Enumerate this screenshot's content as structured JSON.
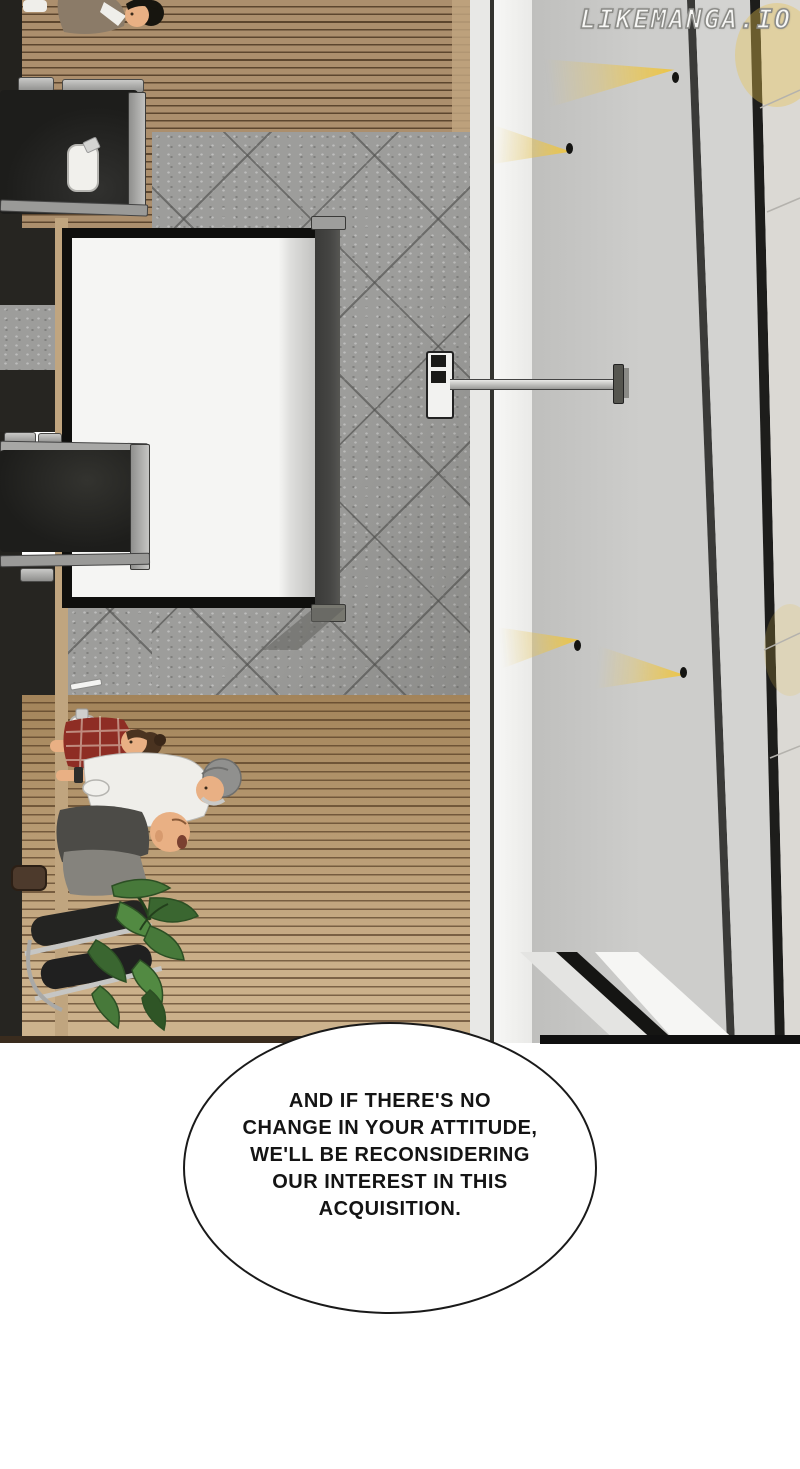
{
  "page": {
    "width_px": 800,
    "height_px": 1469,
    "background": "#ffffff"
  },
  "watermark": {
    "text": "LIKEMANGA.IO"
  },
  "speech_bubble": {
    "lines": [
      "AND IF THERE'S NO",
      "CHANGE IN YOUR ATTITUDE,",
      "WE'LL BE RECONSIDERING",
      "OUR INTEREST IN THIS",
      "ACQUISITION."
    ],
    "text": "AND IF THERE'S NO CHANGE IN YOUR ATTITUDE, WE'LL BE RECONSIDERING OUR INTEREST IN THIS ACQUISITION."
  },
  "scene": {
    "description": "Overhead rotated manga panel of an office meeting room: long wooden table with black chairs and seated men, floor-standing projection screen on speckled stone tile, hallway wall with recessed yellow spotlights, potted plant",
    "objects": [
      "conference-table",
      "office-chairs",
      "businessmen",
      "projection-screen",
      "wall-projector",
      "potted-plant",
      "water-bottle",
      "cup",
      "wall-spotlights"
    ]
  },
  "colors": {
    "wood_base": "#ac8f6d",
    "wood_light": "#c0a57f",
    "wood_pale": "#cdb38d",
    "tile_base": "#9d9d9b",
    "panel_main": "#cdcdcb",
    "strip_white": "#f7f7f5",
    "far_wall": "#dbd9d4",
    "screen_white": "#f5f5f3",
    "frame_black": "#0f0f0d",
    "pole": "#454543",
    "chair_black": "#1d1d1b",
    "chair_frame": "#a2a2a0",
    "table_dark": "#262521",
    "light_yellow": "#eec43e",
    "skin": "#e9b084",
    "shirt_red": "#8e2d24",
    "shirt_white": "#efeeea",
    "cap_gray": "#90908e",
    "tee_gray": "#4c4b47",
    "pants_gray": "#85837d",
    "plant_green": "#47793a",
    "plant_dark": "#2f5526",
    "bubble_border": "#1a1a1a",
    "ink": "#141414",
    "wm_fill": "#f7f7f5",
    "wm_stroke": "#8c8c88"
  }
}
